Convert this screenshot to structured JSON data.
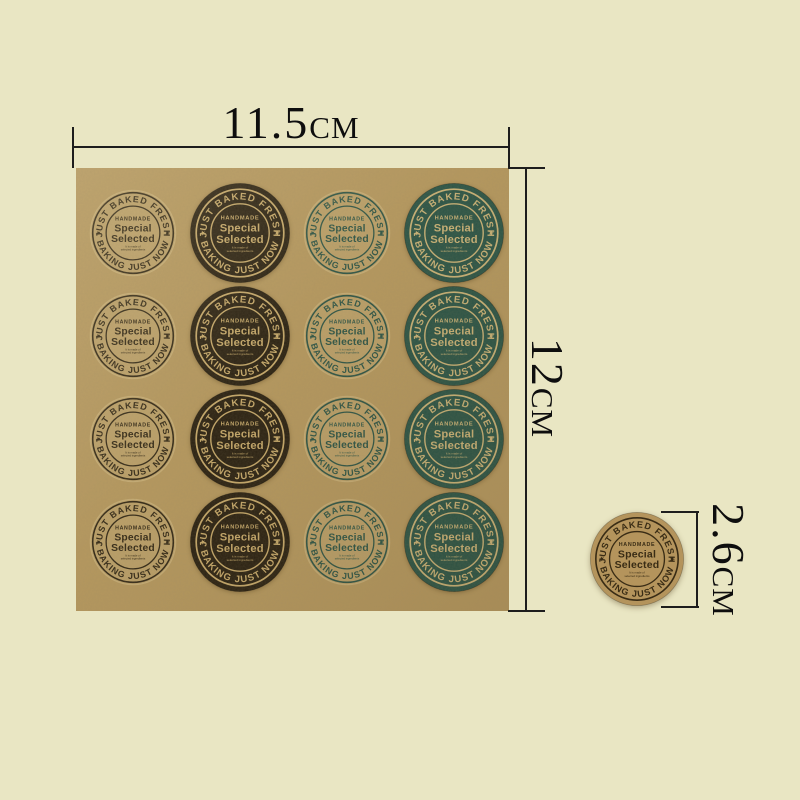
{
  "page": {
    "background_color": "#e9e6c3"
  },
  "product": {
    "sheet": {
      "color": "#b5985f",
      "rows": 4,
      "cols": 4,
      "column_variant_indexes": [
        0,
        1,
        2,
        3
      ]
    },
    "sticker_text": {
      "arc_top": "JUST BAKED FRESH",
      "arc_bottom": "BAKING JUST NOW",
      "side_star": "★",
      "handmade": "HANDMADE",
      "title_line1": "Special",
      "title_line2": "Selected",
      "subtext_line1": "It is made of",
      "subtext_line2": "selected ingredients"
    },
    "variants": [
      {
        "name": "kraft-brown-print",
        "type": "transparent",
        "ink": "#332917",
        "fill": "",
        "die_cut_edge": "#d4bc85"
      },
      {
        "name": "dark-brown",
        "type": "solid",
        "ink": "#c6a96b",
        "fill": "#2b2213"
      },
      {
        "name": "kraft-green-print",
        "type": "transparent",
        "ink": "#2e5547",
        "fill": "",
        "die_cut_edge": "#d4bc85"
      },
      {
        "name": "dark-green",
        "type": "solid",
        "ink": "#c9b277",
        "fill": "#2c5547"
      }
    ],
    "single_sticker_variant": {
      "name": "kraft-single",
      "type": "solid",
      "ink": "#392c15",
      "fill": "#b4945c"
    }
  },
  "dimensions": {
    "width": {
      "value": "11.5",
      "unit": "CM"
    },
    "height": {
      "value": "12",
      "unit": "CM"
    },
    "sticker_diameter": {
      "value": "2.6",
      "unit": "CM"
    }
  },
  "line_color": "#1d1d1d"
}
